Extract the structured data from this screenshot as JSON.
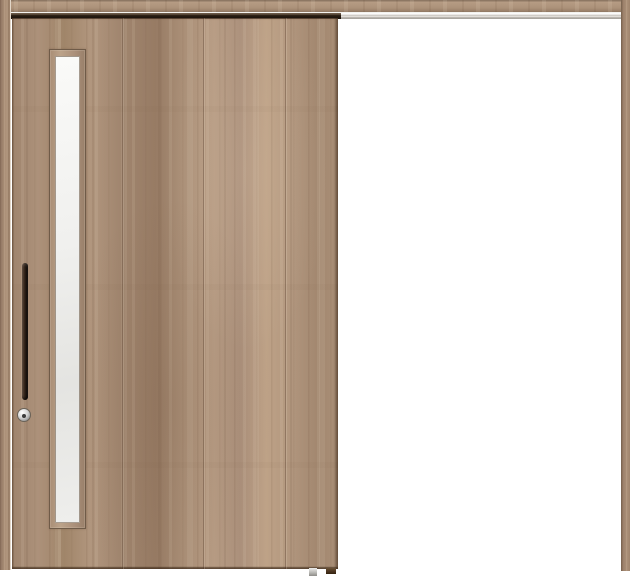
{
  "scene": {
    "type": "product-photo",
    "subject": "single sliding interior door on a top-hung rail, right side open",
    "finish": "light walnut wood grain, vertical planks"
  },
  "components": {
    "header_lintel": "wood header beam across full width",
    "top_rail_track": "silver hanger rail under lintel",
    "track_door_gap": "dark shadow gap above door panel",
    "left_frame_post": "wood jamb, left",
    "right_frame_post": "wood jamb, right",
    "door_panel": "sliding wood door panel, closed over left half",
    "plank_seams": 3,
    "glass_window": "narrow vertical frosted glass slit near handle side",
    "handle": "vertical bar pull, dark bronze",
    "lock": "round silver thumb-turn lock below handle",
    "floor_guide": "small grey floor guide under door bottom edge",
    "floor_stop": "small dark wood stop block at door bottom corner",
    "opening": "white open doorway, right half"
  },
  "colors": {
    "background": "#ffffff",
    "wood_base": "#a88d76",
    "wood_dark": "#8f7460",
    "wood_light": "#bca48c",
    "wood_lintel": "#b0977f",
    "door_edge": "#5a4636",
    "track_silver": "#e3e0da",
    "track_line": "#8f8b85",
    "track_shadow": "#17100a",
    "glass": "#e4e4e1",
    "glass_light": "#f6f6f4",
    "handle_dark": "#17100b",
    "handle_highlight": "#6d5748",
    "lock_silver": "#d6d6d6",
    "lock_center": "#3b3b3b",
    "floor_guide": "#bcbbb7",
    "floor_stop": "#49331f"
  }
}
